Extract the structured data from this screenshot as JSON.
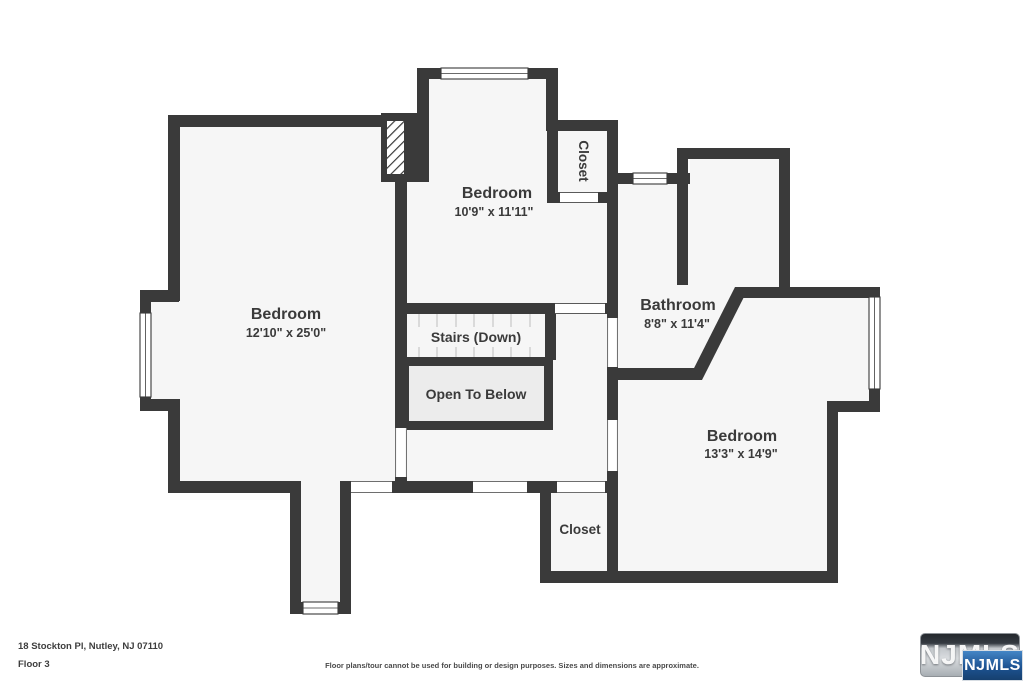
{
  "plan": {
    "wall_color": "#3a3a3a",
    "floor_color": "#f6f6f6",
    "rooms": [
      {
        "name": "Bedroom",
        "dims": "12'10\" x 25'0\""
      },
      {
        "name": "Bedroom",
        "dims": "10'9\" x 11'11\""
      },
      {
        "name": "Bathroom",
        "dims": "8'8\" x 11'4\""
      },
      {
        "name": "Bedroom",
        "dims": "13'3\" x 14'9\""
      },
      {
        "name": "Closet"
      },
      {
        "name": "Closet"
      }
    ],
    "labels": {
      "stairs": "Stairs (Down)",
      "open_to_below": "Open To Below"
    }
  },
  "footer": {
    "address": "18 Stockton Pl, Nutley, NJ 07110",
    "floor": "Floor 3",
    "disclaimer": "Floor plans/tour cannot be used for building or design purposes. Sizes and dimensions are approximate."
  },
  "logo": {
    "brand": "NJMLS",
    "badge": "NJMLS",
    "badge_color": "#1d5392"
  }
}
